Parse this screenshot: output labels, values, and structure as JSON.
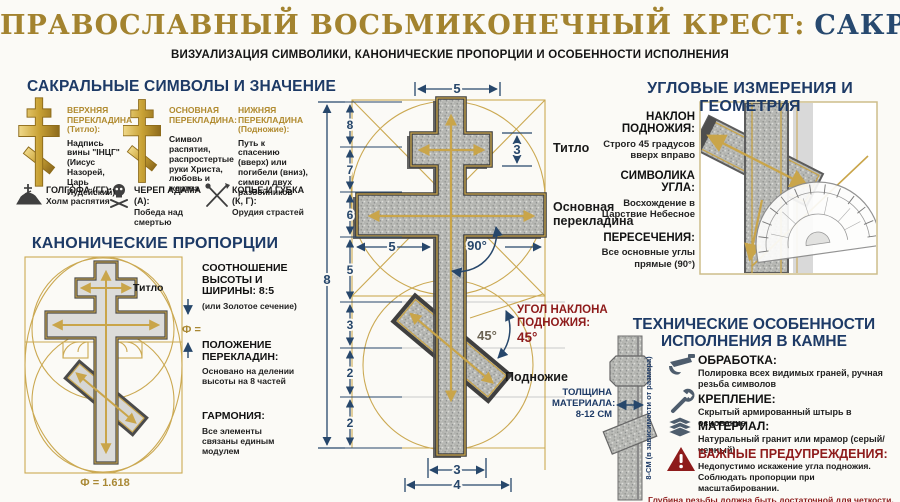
{
  "header": {
    "title_part1": "ПРАВОСЛАВНЫЙ ВОСЬМИКОНЕЧНЫЙ КРЕСТ:",
    "title_part2": "САКРАЛЬНАЯ ГЕОМЕТРИЯ",
    "subtitle": "ВИЗУАЛИЗАЦИЯ СИМВОЛИКИ, КАНОНИЧЕСКИЕ ПРОПОРЦИИ И ОСОБЕННОСТИ ИСПОЛНЕНИЯ"
  },
  "colors": {
    "title_gold": "#a3832f",
    "title_navy": "#27496f",
    "heading_navy": "#1d3a66",
    "accent_gold": "#c9a54a",
    "dimension_navy": "#27476b",
    "warning_maroon": "#8e1b1b"
  },
  "symbols_section": {
    "heading": "САКРАЛЬНЫЕ СИМВОЛЫ И ЗНАЧЕНИЕ",
    "columns": [
      {
        "title": "ВЕРХНЯЯ ПЕРЕКЛАДИНА (Титло):",
        "body": "Надпись вины \"ІНЦГ\" (Иисус Назорей, Царь Иудейский)"
      },
      {
        "title": "ОСНОВНАЯ ПЕРЕКЛАДИНА:",
        "body": "Символ распятия, распростертые руки Христа, любовь и жертва"
      },
      {
        "title": "НИЖНЯЯ ПЕРЕКЛАДИНА (Подножие):",
        "body": "Путь к спасению (вверх) или погибели (вниз), символ двух разбойников"
      }
    ],
    "glossary": [
      {
        "icon": "golgotha-icon",
        "term": "ГОЛГОФА (ГГ):",
        "desc": "Холм распятия"
      },
      {
        "icon": "skull-icon",
        "term": "ЧЕРЕП АДАМА (А):",
        "desc": "Победа над смертью"
      },
      {
        "icon": "spear-sponge-icon",
        "term": "КОПЬЕ И ГУБКА (К, Г):",
        "desc": "Орудия страстей"
      }
    ]
  },
  "proportions_section": {
    "heading": "КАНОНИЧЕСКИЕ ПРОПОРЦИИ",
    "diagram": {
      "titlo_label": "Титло",
      "phi_eq": "Ф =",
      "phi_value": "Ф = 1.618"
    },
    "items": [
      {
        "title": "СООТНОШЕНИЕ ВЫСОТЫ И ШИРИНЫ: 8:5",
        "body": "(или Золотое сечение)"
      },
      {
        "title": "ПОЛОЖЕНИЕ ПЕРЕКЛАДИН:",
        "body": "Основано на делении высоты на 8 частей"
      },
      {
        "title": "ГАРМОНИЯ:",
        "body": "Все элементы связаны единым модулем"
      }
    ]
  },
  "main_diagram": {
    "dim_top_width": "5",
    "dim_titlo_height": "3",
    "dim_total_height": "8",
    "ruler_segments": [
      "8",
      "7",
      "6",
      "5",
      "3",
      "2",
      "2"
    ],
    "dim_mid_width": "5",
    "angle_main": "90°",
    "angle_foot": "45°",
    "label_titlo": "Титло",
    "label_main_line1": "Основная",
    "label_main_line2": "перекладина",
    "label_foot": "Подножие",
    "callout_line1": "УГОЛ НАКЛОНА",
    "callout_line2": "ПОДНОЖИЯ:",
    "callout_value": "45°",
    "dim_bottom_inner": "3",
    "dim_bottom_outer": "4"
  },
  "angles_section": {
    "heading": "УГЛОВЫЕ ИЗМЕРЕНИЯ И ГЕОМЕТРИЯ",
    "items": [
      {
        "title": "НАКЛОН ПОДНОЖИЯ:",
        "body": "Строго 45 градусов вверх вправо"
      },
      {
        "title": "СИМВОЛИКА УГЛА:",
        "body": "Восхождение в Царствие Небесное"
      },
      {
        "title": "ПЕРЕСЕЧЕНИЯ:",
        "body": "Все основные углы прямые (90°)"
      }
    ]
  },
  "technical_section": {
    "heading_line1": "ТЕХНИЧЕСКИЕ ОСОБЕННОСТИ",
    "heading_line2": "ИСПОЛНЕНИЯ В КАМНЕ",
    "items": [
      {
        "icon": "polish-tool-icon",
        "title": "ОБРАБОТКА:",
        "body": "Полировка всех видимых граней, ручная резьба символов"
      },
      {
        "icon": "wrench-icon",
        "title": "КРЕПЛЕНИЕ:",
        "body": "Скрытый армированный штырь в основание"
      },
      {
        "icon": "layers-icon",
        "title": "МАТЕРИАЛ:",
        "body": "Натуральный гранит или мрамор (серый/черный)"
      }
    ],
    "warning": {
      "icon": "warning-triangle-icon",
      "title": "ВАЖНЫЕ ПРЕДУПРЕЖДЕНИЯ:",
      "lines": [
        "Недопустимо искажение угла подножия.",
        "Соблюдать пропорции при масштабировании.",
        "Глубина резьбы должна быть достаточной для четкости."
      ]
    },
    "thickness": {
      "label_line1": "ТОЛЩИНА",
      "label_line2": "МАТЕРИАЛА:",
      "label_line3": "8-12 СМ",
      "side_note": "8-СМ (в зависимости от размера)"
    }
  }
}
